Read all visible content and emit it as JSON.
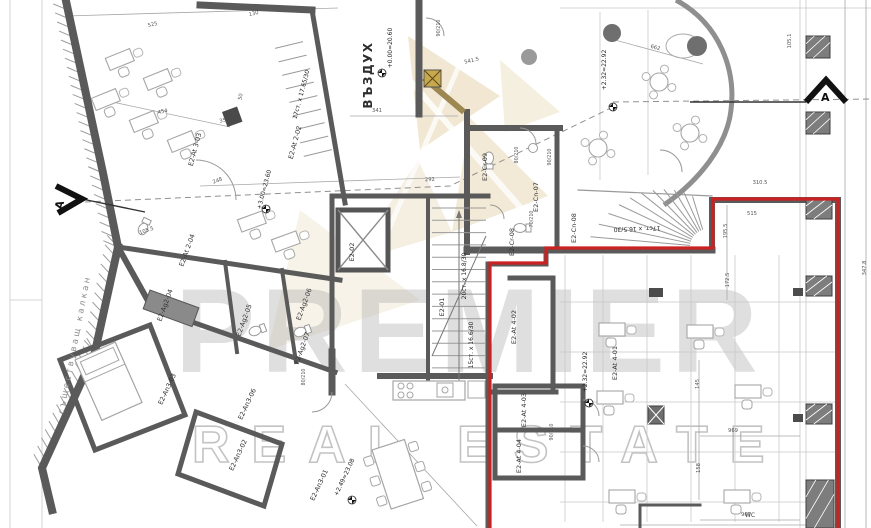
{
  "watermark": {
    "brand": "PREMIER",
    "tagline": "REAL ESTATE"
  },
  "colors": {
    "outline_red": "#c92222",
    "wall_gray": "#5a5a5a",
    "watermark_tan": "#d8bf8a",
    "watermark_gray": "#b9b9b9"
  },
  "plan": {
    "air_shaft": "ВЪЗДУХ",
    "party_wall": "съществуващ калкан",
    "section_a": "A",
    "wc": "WC",
    "rooms": [
      "E2-At 3-03",
      "E2-At 2-02",
      "E2-At 2-04",
      "E2-Ag2-04",
      "E2-Ag2-05",
      "E2-Ag2-06",
      "E2-Ag2-07",
      "E2-An3-03",
      "E2-An3-06",
      "E2-An3-02",
      "E2-An3-01",
      "E2-02",
      "E2-01",
      "E2-Cr-09",
      "E2-Cn-07",
      "E2-Cr-08",
      "E2-Cn-08",
      "E2-At 4-02",
      "E2-At 4-01",
      "E2-At 4-03",
      "E2-At 4-04"
    ],
    "elevations": [
      "+0.00=20.60",
      "+2.32=22.92",
      "+3.00=23.60",
      "+2.49=23.08",
      "+2.32=22.92"
    ],
    "stairs": [
      "20ст. x 16.8/30",
      "15ст. x 16.6/30",
      "17ст. x 16.5/30",
      "17ст. x 17.65/30"
    ],
    "doors": [
      "90/210",
      "80/210",
      "90/210",
      "90/210",
      "80/210",
      "70/210"
    ],
    "dims": [
      "525",
      "130",
      "454",
      "35",
      "50",
      "341",
      "541.5",
      "662",
      "292",
      "248",
      "105.5",
      "310.5",
      "195.5",
      "515",
      "172.5",
      "145",
      "158",
      "969",
      "967",
      "347.8",
      "105.1"
    ]
  }
}
